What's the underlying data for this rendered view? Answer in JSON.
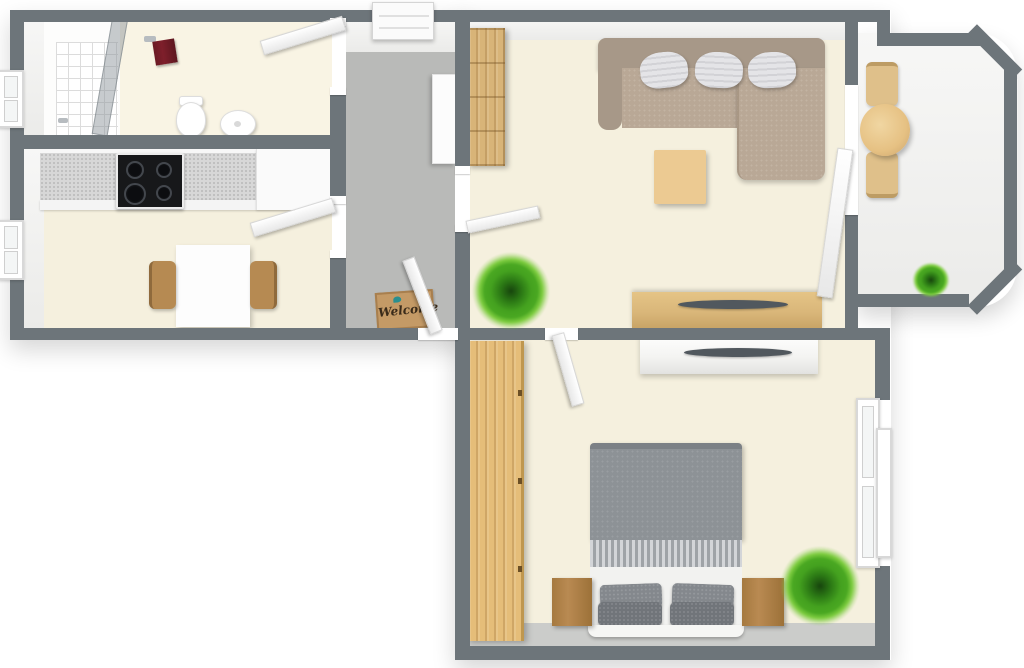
{
  "scene": {
    "type": "3d-apartment-floor-plan-top-view",
    "doormat_text": "Welcome"
  },
  "rooms": [
    {
      "name": "bathroom",
      "furniture": [
        "shower",
        "shower-glass",
        "toilet",
        "sink",
        "red-towel",
        "window"
      ]
    },
    {
      "name": "kitchen",
      "furniture": [
        "countertop",
        "cooktop",
        "white-cabinets",
        "dining-table",
        "two-wood-chairs",
        "window"
      ]
    },
    {
      "name": "hallway",
      "furniture": [
        "white-closet",
        "shoe-cabinet",
        "welcome-doormat",
        "entrance-door"
      ]
    },
    {
      "name": "living-room",
      "furniture": [
        "tall-wood-shelf",
        "l-shaped-sofa",
        "three-pillows",
        "coffee-table",
        "wood-sideboard-with-tv",
        "plant",
        "balcony-door"
      ]
    },
    {
      "name": "balcony",
      "furniture": [
        "round-table",
        "two-chairs",
        "potted-plant"
      ]
    },
    {
      "name": "bedroom",
      "furniture": [
        "wood-wardrobe",
        "double-bed",
        "two-nightstands",
        "white-sideboard-with-tv",
        "plant",
        "window"
      ]
    }
  ],
  "palette": {
    "wall": "#6d757a",
    "floor_cream": "#f5f0de",
    "floor_hall": "#b9bab8",
    "floor_strip": "#cbccca",
    "floor_balcony": "#f1e8e4",
    "counter": "#d7d7d7",
    "cooktop": "#17181a",
    "sofa_frame": "#a79888",
    "sofa_seat": "#b9a896",
    "pillow_white": "#e4e4e7",
    "wood_light": "#ecca92",
    "wood_shelf": "#d8b478",
    "wood_side": "#d9b679",
    "wood_wardrobe": "#e5bd79",
    "wood_night": "#b98a52",
    "wood_chair": "#b68a52",
    "bed_duvet": "#8d9296",
    "bed_pillow": "#7d8287",
    "tv_dark": "#51585e",
    "towel_red": "#7e1f2b",
    "plant_green": "#4aa822",
    "mat_tan": "#c49a66",
    "mat_text": "#3a2b1a",
    "mat_bird": "#2a8f8f"
  }
}
